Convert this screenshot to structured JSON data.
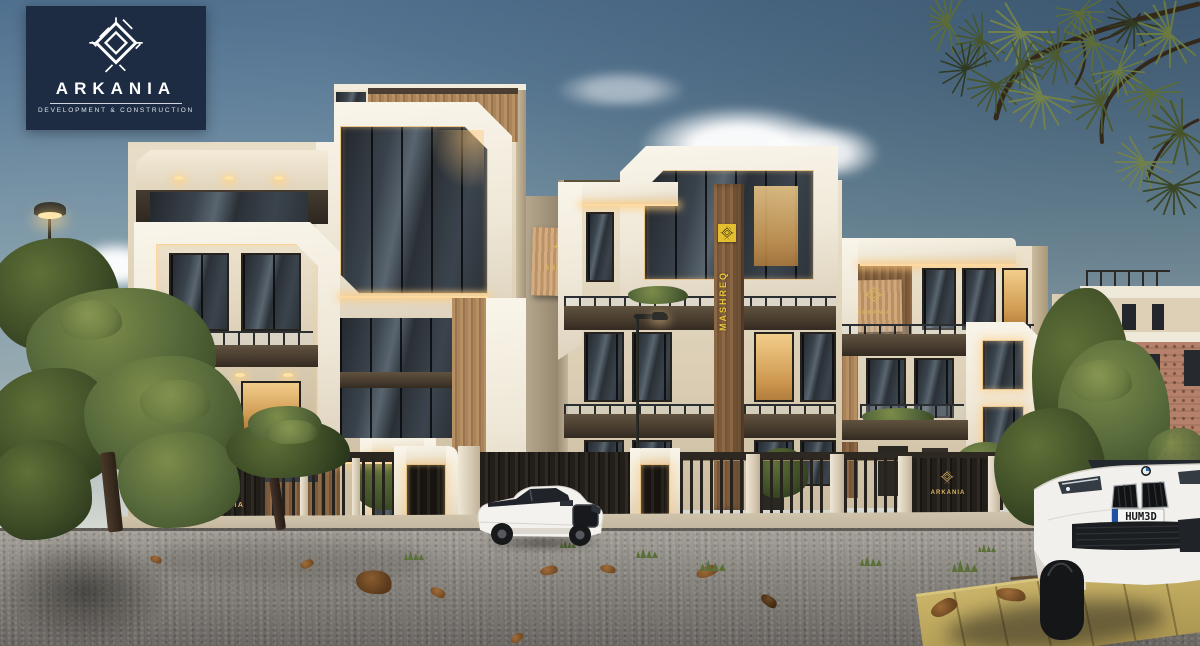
{
  "brand": {
    "name": "ARKANIA",
    "tagline": "DEVELOPMENT & CONSTRUCTION"
  },
  "signs": {
    "left_building_panel": "ARKANIA",
    "right_building_panel": "ARKANIA",
    "vertical_banner": "MASHREQ",
    "left_gate": "ARKANIA",
    "right_gate": "ARKANIA"
  },
  "vehicles": {
    "sedan_plate": "HUM3D"
  },
  "palette": {
    "brand_navy": "#1d2c42",
    "brand_gold": "#d9b35e",
    "banner_yellow": "#e3bf2f",
    "facade_cream": "#e8dfcc",
    "frame_white": "#f6f1e6",
    "bronze_dark": "#53463a",
    "wood": "#b08a5f",
    "led_warm": "#ffd9a0",
    "sky_top": "#50708f"
  }
}
